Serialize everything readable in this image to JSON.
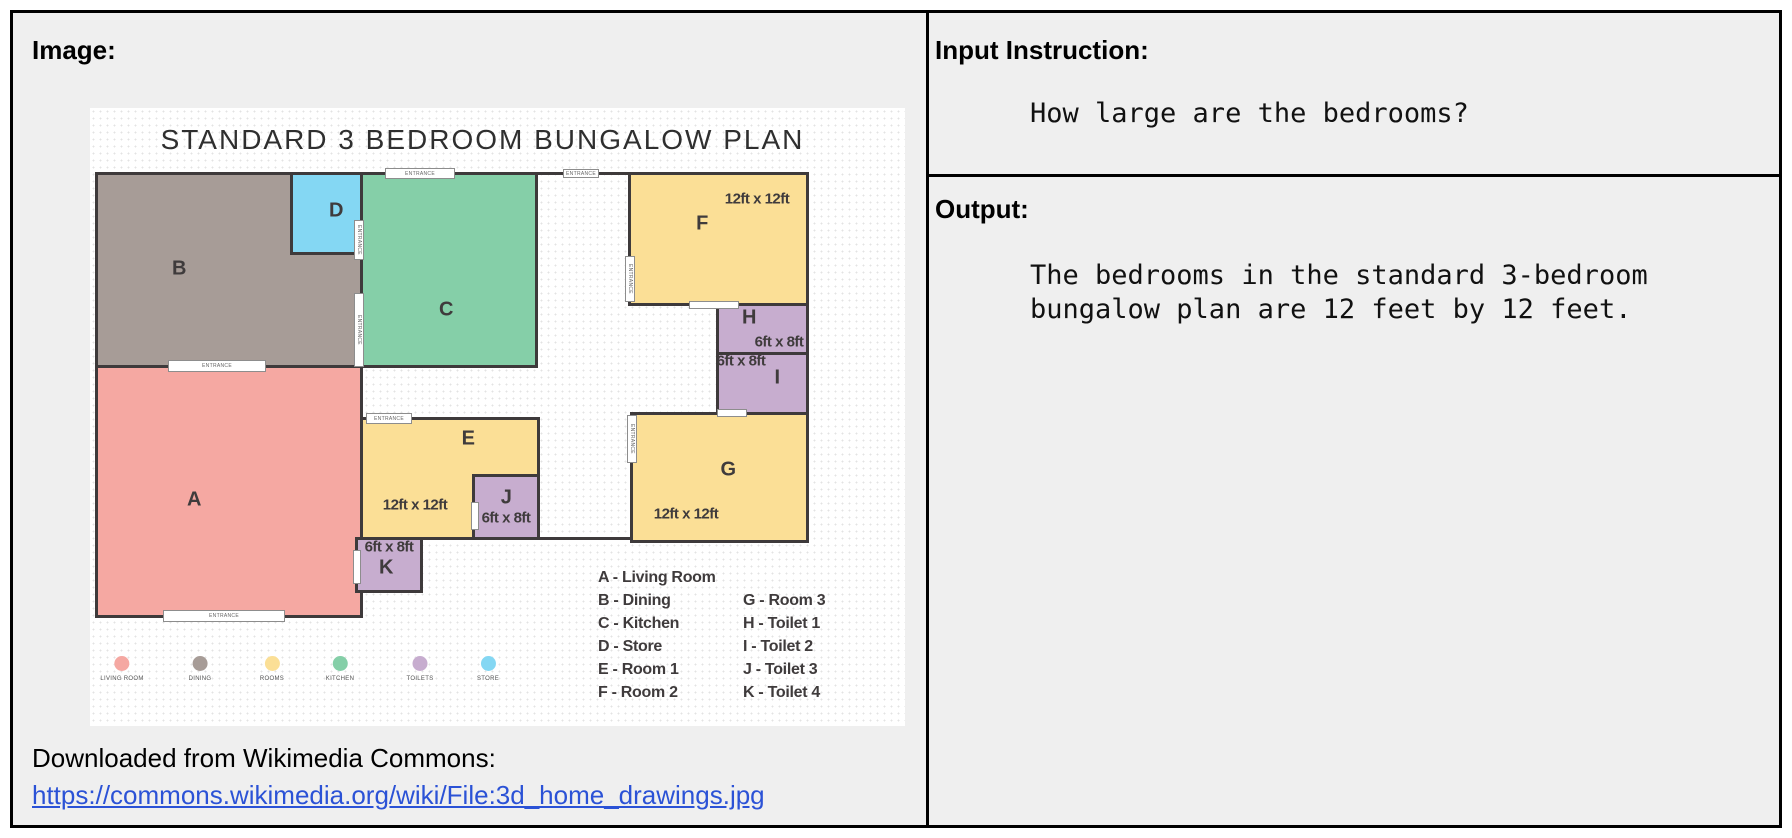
{
  "left_panel": {
    "label": "Image:",
    "plan": {
      "title": "STANDARD 3 BEDROOM BUNGALOW PLAN",
      "entrance_label": "ENTRANCE",
      "rooms": {
        "A": {
          "letter": "A"
        },
        "B": {
          "letter": "B"
        },
        "C": {
          "letter": "C"
        },
        "D": {
          "letter": "D"
        },
        "E": {
          "letter": "E",
          "dims": "12ft x 12ft"
        },
        "F": {
          "letter": "F",
          "dims": "12ft x 12ft"
        },
        "G": {
          "letter": "G",
          "dims": "12ft x 12ft"
        },
        "H": {
          "letter": "H",
          "dims": "6ft x 8ft"
        },
        "I": {
          "letter": "I",
          "dims": "6ft x 8ft"
        },
        "J": {
          "letter": "J",
          "dims": "6ft x 8ft"
        },
        "K": {
          "letter": "K",
          "dims": "6ft x 8ft"
        }
      },
      "legend_col1": [
        "A - Living Room",
        "B - Dining",
        "C - Kitchen",
        "D - Store",
        "E - Room 1",
        "F - Room 2"
      ],
      "legend_col2": [
        "G - Room 3",
        "H - Toilet 1",
        "I - Toilet 2",
        "J - Toilet 3",
        "K - Toilet 4"
      ],
      "color_key": [
        {
          "label": "LIVING ROOM",
          "color": "#f5a8a2"
        },
        {
          "label": "DINING",
          "color": "#a79c97"
        },
        {
          "label": "ROOMS",
          "color": "#fbdf96"
        },
        {
          "label": "KITCHEN",
          "color": "#85cfa8"
        },
        {
          "label": "TOILETS",
          "color": "#c7adcf"
        },
        {
          "label": "STORE",
          "color": "#84d7f3"
        }
      ]
    },
    "source_text": "Downloaded from Wikimedia Commons:",
    "source_link": "https://commons.wikimedia.org/wiki/File:3d_home_drawings.jpg"
  },
  "right_panel": {
    "input_label": "Input Instruction:",
    "input_text": "How large are the bedrooms?",
    "output_label": "Output:",
    "output_text": "The bedrooms in the standard 3-bedroom bungalow plan are 12 feet by 12 feet."
  }
}
